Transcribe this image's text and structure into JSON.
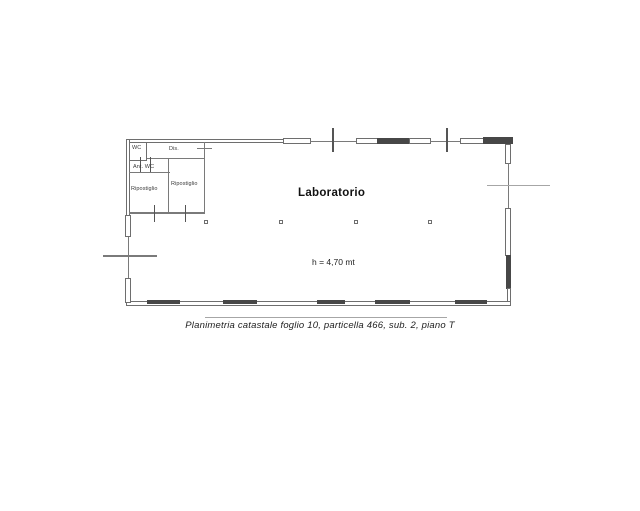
{
  "plan": {
    "rooms": {
      "wc": "WC",
      "dis": "Dis.",
      "ant_wc": "Ant. WC",
      "ripostiglio_left": "Ripostiglio",
      "ripostiglio_right": "Ripostiglio",
      "laboratorio": "Laboratorio"
    },
    "height_note": "h = 4,70 mt"
  },
  "caption": "Planimetria catastale foglio 10, particella 466, sub. 2, piano T",
  "colors": {
    "wall_line": "#6e6e6e",
    "dark_segment": "#474747",
    "text": "#222222",
    "background": "#ffffff"
  }
}
